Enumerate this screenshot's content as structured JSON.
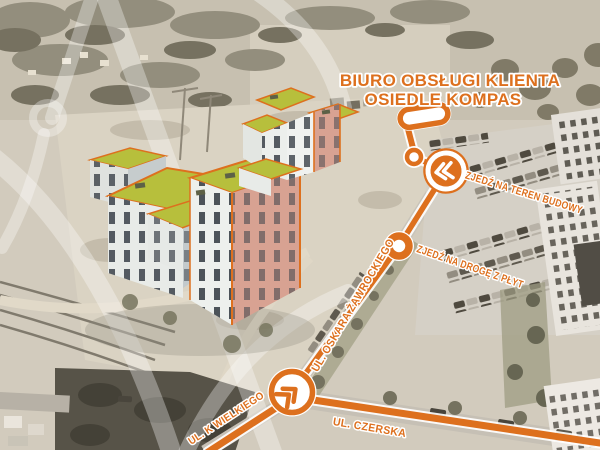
{
  "theme": {
    "accent": "#dd701e",
    "accent_deep": "#c9610f",
    "roof": "#b7bf3c",
    "salmon": "#d8a292",
    "win": "#3a4149",
    "photo_base": "#d2cdc1"
  },
  "header": {
    "title_line1": "BIURO OBSŁUGI KLIENTA",
    "title_line2": "OSIEDLE KOMPAS"
  },
  "map": {
    "streets": [
      {
        "name": "UL. OSKARA ŻAWROCKIEGO"
      },
      {
        "name": "UL. K WIELKIEGO"
      },
      {
        "name": "UL. CZERSKA"
      }
    ],
    "instructions": [
      {
        "label": "ZJEDŹ NA TEREN BUDOWY"
      },
      {
        "label": "ZJEDŹ NA DROGĘ Z PŁYT"
      }
    ],
    "markers": [
      {
        "icon": "office-location-pin"
      },
      {
        "icon": "route-node-ring"
      },
      {
        "icon": "turn-chevron-left-badge"
      },
      {
        "icon": "waypoint-donut"
      },
      {
        "icon": "junction-chevron-up-right-badge"
      }
    ],
    "watermark": {
      "icon": "kompas-compass-watermark"
    }
  }
}
